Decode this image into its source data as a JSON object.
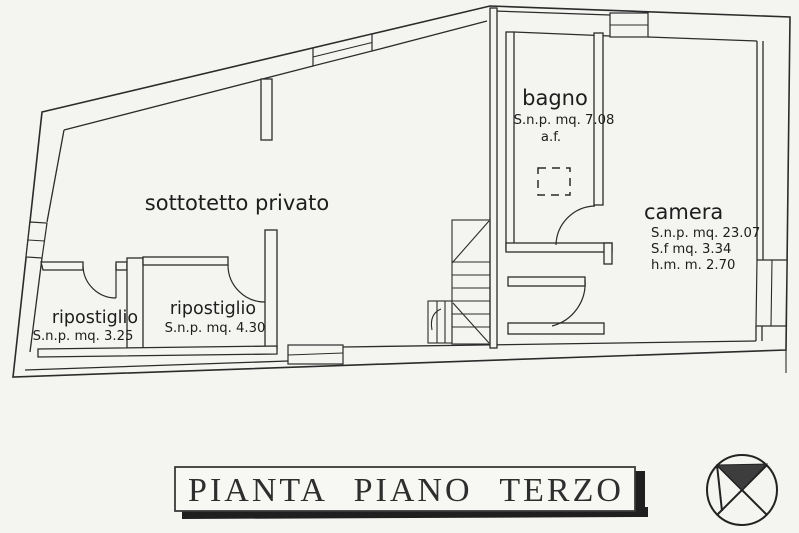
{
  "scan": {
    "paper_color": "#f4f4f1",
    "ink_color": "#2b2b2b"
  },
  "rooms": {
    "sottotetto": {
      "label": "sottotetto privato"
    },
    "bagno": {
      "label": "bagno",
      "area": "S.n.p. mq. 7.08",
      "note": "a.f."
    },
    "camera": {
      "label": "camera",
      "area": "S.n.p. mq. 23.07",
      "surface": "S.f mq. 3.34",
      "height": "h.m.  m. 2.70"
    },
    "ripostiglio_left": {
      "label": "ripostiglio",
      "area": "S.n.p. mq. 3.25"
    },
    "ripostiglio_right": {
      "label": "ripostiglio",
      "area": "S.n.p. mq. 4.30"
    }
  },
  "title_banner": {
    "text": "PIANTA PIANO TERZO"
  }
}
